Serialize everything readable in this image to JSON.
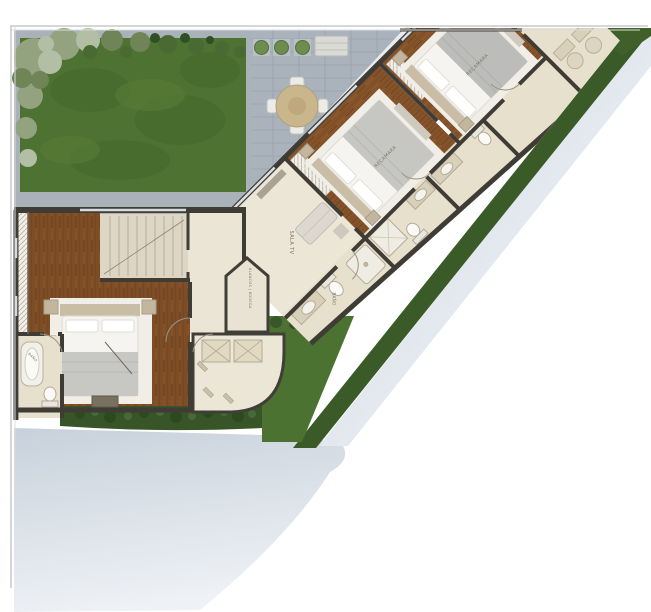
{
  "plan": {
    "labels": {
      "bedroom_top": "RECAMARA",
      "bedroom_mid": "RECAMARA",
      "tv_room": "SALA TV",
      "wing_bath": "BAÑO",
      "master_bath": "BAÑO",
      "linen_storage": "BLANCOS | BODEGA"
    },
    "colors": {
      "grass": "#4d7232",
      "hedge": "#375527",
      "wood_floor": "#845329",
      "tile": "#ece6d7",
      "bath_tile": "#e7e0cd",
      "wall": "#3f3c36",
      "patio": "#aab3bc",
      "driveway": "#c7d1db"
    }
  }
}
